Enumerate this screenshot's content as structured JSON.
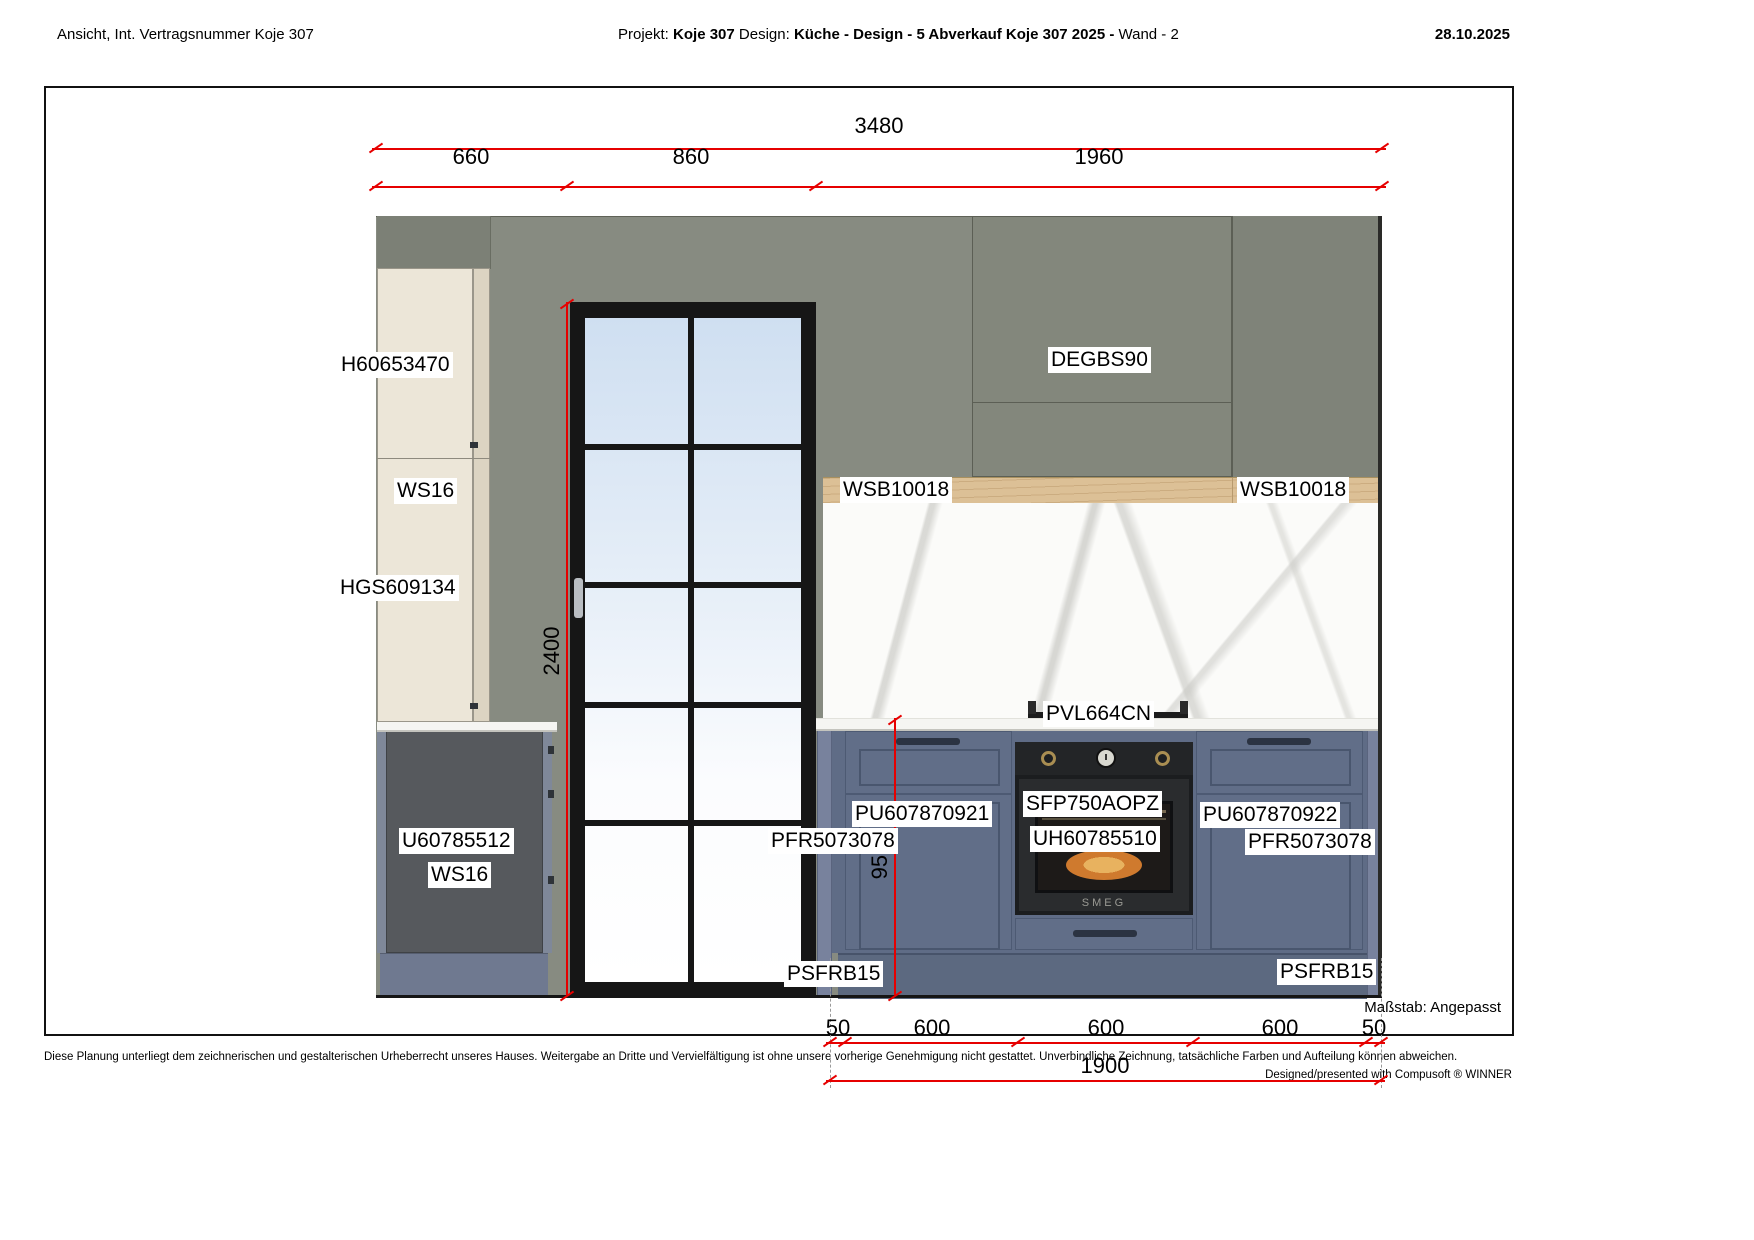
{
  "header": {
    "left": "Ansicht, Int. Vertragsnummer Koje 307",
    "project_label": "Projekt:",
    "project_name": "Koje 307",
    "design_label": "Design:",
    "design_value": "Küche - Design - 5 Abverkauf Koje 307 2025 -",
    "wall_ref": "Wand - 2",
    "date": "28.10.2025"
  },
  "dims": {
    "total": "3480",
    "seg_left": "660",
    "seg_door": "860",
    "seg_right": "1960",
    "door_height": "2400",
    "worktop_height": "950",
    "b50a": "50",
    "b600a": "600",
    "b600b": "600",
    "b600c": "600",
    "b50b": "50",
    "btotal": "1900"
  },
  "labels": {
    "tall_upper_unit": "H60653470",
    "side_panel_upper": "WS16",
    "tall_lower_unit": "HGS609134",
    "base_left_unit": "U60785512",
    "side_panel_base": "WS16",
    "wall_unit_right": "DEGBS90",
    "shelf_left": "WSB10018",
    "shelf_right": "WSB10018",
    "hob": "PVL664CN",
    "frame_left": "PFR5073078",
    "base_run_left": "PU607870921",
    "oven_model": "SFP750AOPZ",
    "oven_housing": "UH60785510",
    "base_run_right": "PU607870922",
    "frame_right": "PFR5073078",
    "plinth_left": "PSFRB15",
    "plinth_right": "PSFRB15"
  },
  "oven": {
    "brand": "SMEG"
  },
  "scale_note": "Maßstab: Angepasst",
  "footer": {
    "left": "Diese Planung unterliegt dem zeichnerischen und gestalterischen Urheberrecht unseres Hauses. Weitergabe an Dritte und Vervielfältigung ist ohne unsere vorherige Genehmigung nicht gestattet. Unverbindliche Zeichnung, tatsächliche Farben und Aufteilung können abweichen.",
    "right": "Designed/presented with Compusoft ® WINNER"
  },
  "colors": {
    "dimension_red": "#e60000",
    "wall_gray_green": "#878b81",
    "cream_cabinet": "#ece6d8",
    "dark_base_cabinet": "#56595d",
    "blue_cabinet": "#616e88",
    "blue_plinth": "#5c6980",
    "wood_shelf": "#dcc096",
    "door_frame_black": "#161616",
    "marble_white": "#fbfbf9"
  }
}
